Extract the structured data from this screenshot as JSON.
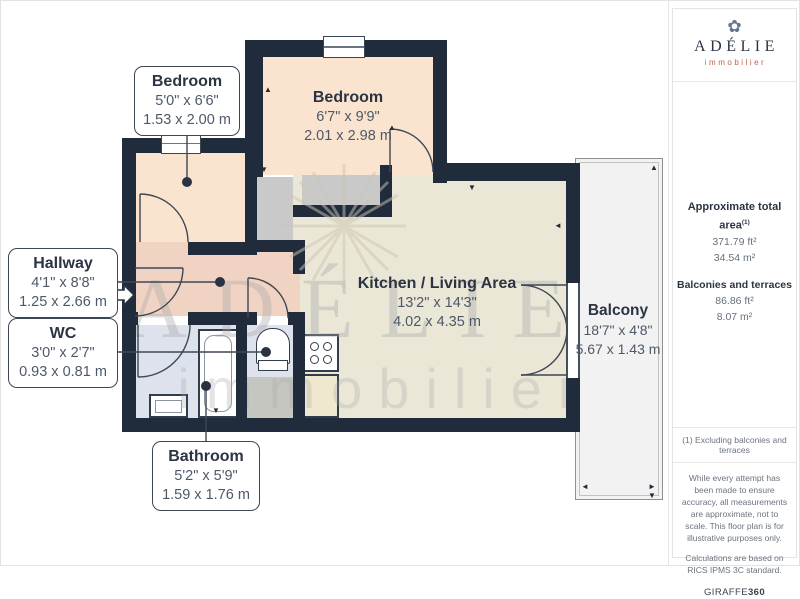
{
  "plan": {
    "rooms": {
      "bedroom1": {
        "name": "Bedroom",
        "imperial": "5'0\" x 6'6\"",
        "metric": "1.53 x 2.00 m"
      },
      "bedroom2": {
        "name": "Bedroom",
        "imperial": "6'7\" x 9'9\"",
        "metric": "2.01 x 2.98 m"
      },
      "hallway": {
        "name": "Hallway",
        "imperial": "4'1\" x 8'8\"",
        "metric": "1.25 x 2.66 m"
      },
      "wc": {
        "name": "WC",
        "imperial": "3'0\" x 2'7\"",
        "metric": "0.93 x 0.81 m"
      },
      "kitchen_living": {
        "name": "Kitchen / Living Area",
        "imperial": "13'2\" x 14'3\"",
        "metric": "4.02 x 4.35 m"
      },
      "balcony": {
        "name": "Balcony",
        "imperial": "18'7\" x 4'8\"",
        "metric": "5.67 x 1.43 m"
      },
      "bathroom": {
        "name": "Bathroom",
        "imperial": "5'2\" x 5'9\"",
        "metric": "1.59 x 1.76 m"
      }
    },
    "watermark": {
      "line1": "ADÉLIE",
      "line2": "immobilier"
    }
  },
  "sidebar": {
    "logo": {
      "name": "ADÉLIE",
      "tagline": "immobilier",
      "icon": "snowflake-icon"
    },
    "areas": {
      "total_label": "Approximate total area",
      "total_footnote_ref": "(1)",
      "total_ft": "371.79 ft²",
      "total_m": "34.54 m²",
      "balconies_label": "Balconies and terraces",
      "balconies_ft": "86.86 ft²",
      "balconies_m": "8.07 m²"
    },
    "footnote": "(1) Excluding balconies and terraces",
    "disclaimer1": "While every attempt has been made to ensure accuracy, all measurements are approximate, not to scale. This floor plan is for illustrative purposes only.",
    "disclaimer2": "Calculations are based on RICS IPMS 3C standard.",
    "brand": "GIRAFFE",
    "brand_suffix": "360"
  },
  "colors": {
    "wall": "#202c3b",
    "bedroom_floor": "#fbe4cf",
    "hallway_floor": "#f1d3c3",
    "living_floor": "#ebe7d7",
    "bath_floor": "#dde2ed",
    "closet_floor": "#c9c9c9",
    "balcony_floor": "#f2f2f2",
    "brand_accent": "#c4604a"
  }
}
